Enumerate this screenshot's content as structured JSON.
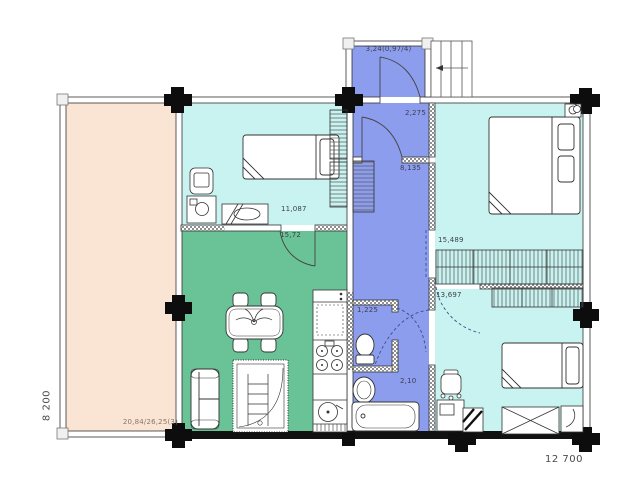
{
  "plan": {
    "rooms": {
      "vestibule": {
        "area": "3,24(0,97/4)"
      },
      "hall": {
        "area": "2,275"
      },
      "corridor": {
        "area": "8,135"
      },
      "bedroom_top_left": {
        "area": "11,087"
      },
      "living_kitchen": {
        "area": "15,72"
      },
      "bedroom_top_right": {
        "area": "15,489"
      },
      "bedroom_bottom_right": {
        "area": "13,697"
      },
      "wc": {
        "area": "1,225"
      },
      "bathroom": {
        "area": "2,10"
      },
      "terrace": {
        "area": "20,84/26,25(3)"
      }
    },
    "dimensions": {
      "overall_width": "12 700",
      "overall_depth": "8 200"
    },
    "colors": {
      "terrace": "#fae4d3",
      "bedroom": "#c8f3f0",
      "living": "#6ac397",
      "wet_zone": "#8d9ded",
      "wall": "#111111"
    }
  }
}
